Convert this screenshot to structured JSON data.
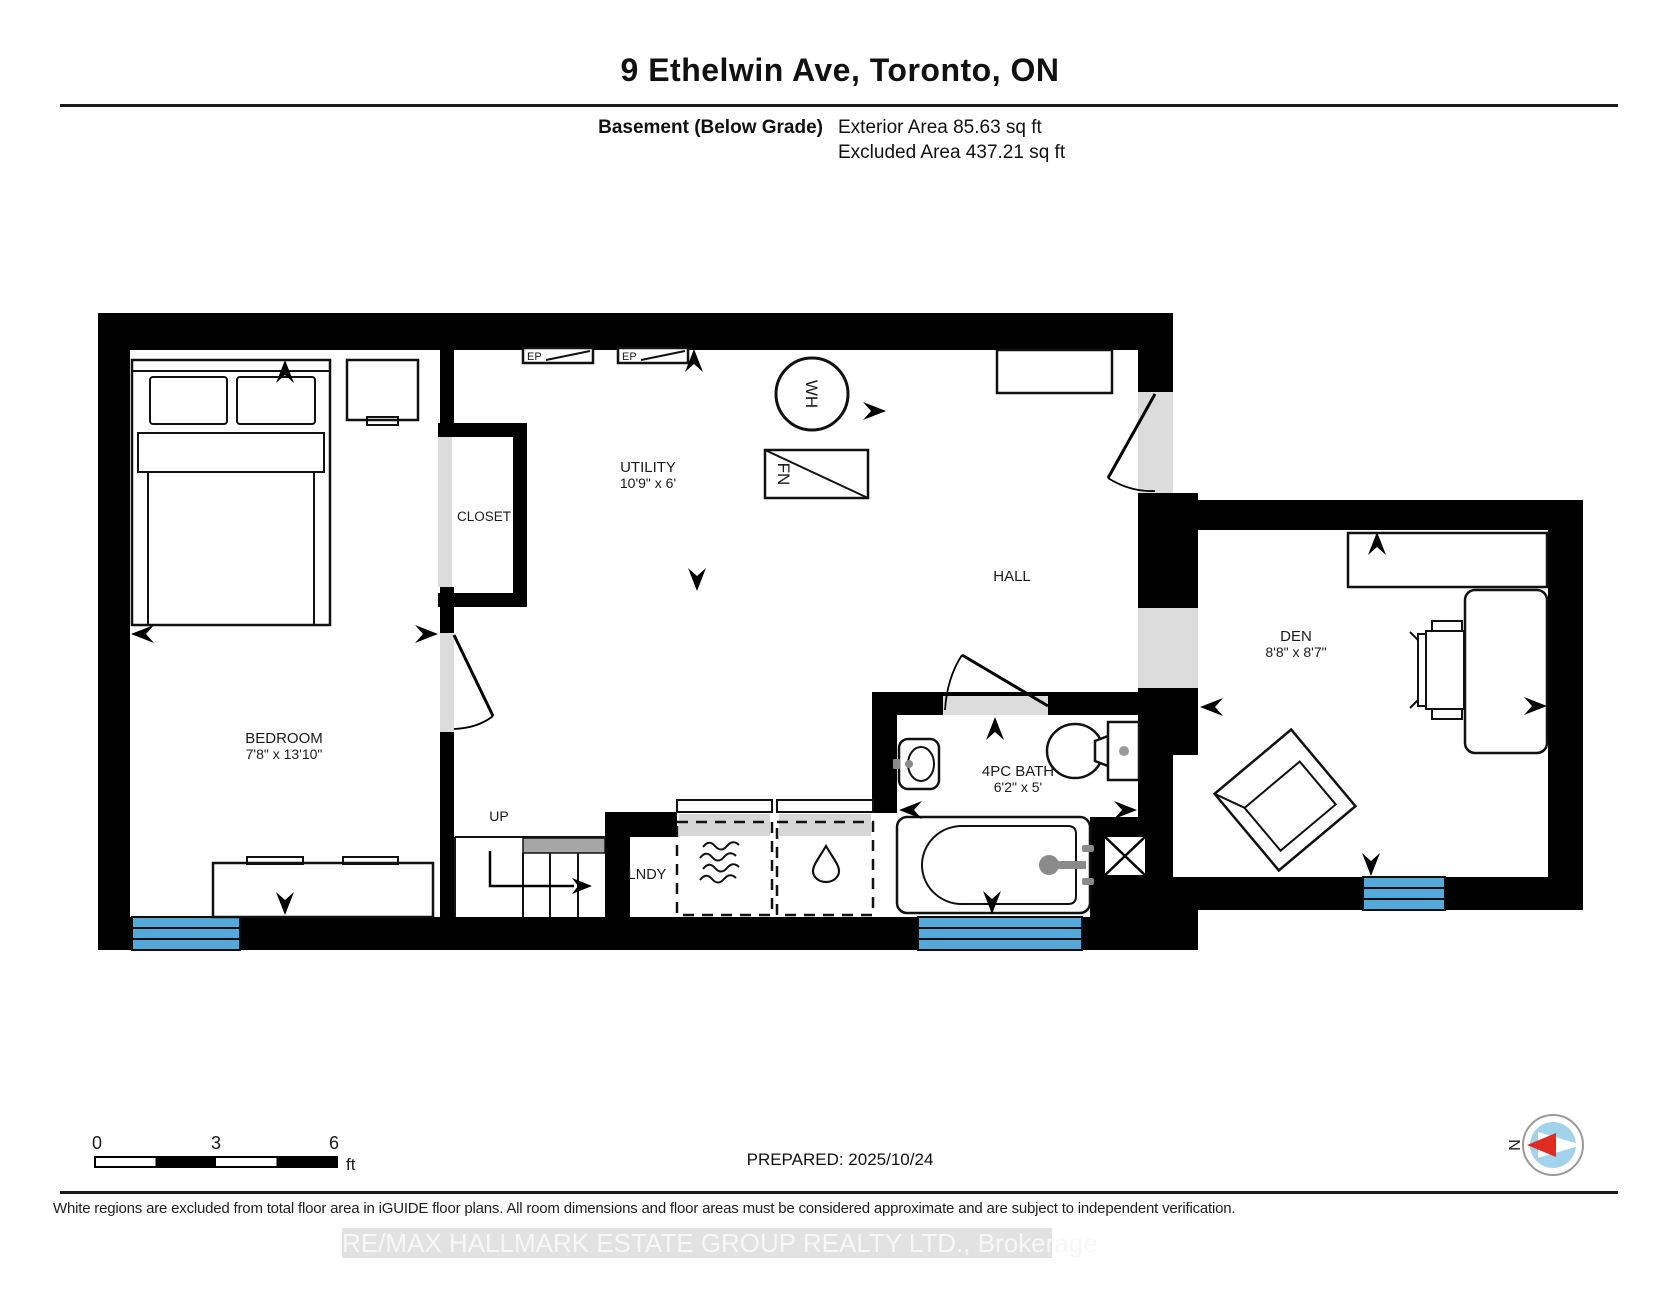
{
  "header": {
    "address": "9 Ethelwin Ave, Toronto, ON",
    "floor_label": "Basement (Below Grade)",
    "exterior_area": "Exterior Area 85.63 sq ft",
    "excluded_area": "Excluded Area 437.21 sq ft"
  },
  "rooms": {
    "bedroom": {
      "name": "BEDROOM",
      "dims": "7'8\" x 13'10\""
    },
    "closet": {
      "name": "CLOSET"
    },
    "utility": {
      "name": "UTILITY",
      "dims": "10'9\" x 6'"
    },
    "hall": {
      "name": "HALL"
    },
    "den": {
      "name": "DEN",
      "dims": "8'8\" x 8'7\""
    },
    "bath": {
      "name": "4PC BATH",
      "dims": "6'2\" x 5'"
    },
    "laundry": {
      "name": "LNDY"
    }
  },
  "equipment": {
    "water_heater": "WH",
    "furnace": "FN",
    "electrical_panel_1": "EP",
    "electrical_panel_2": "EP",
    "stairs_up": "UP"
  },
  "scale_bar": {
    "tick_0": "0",
    "tick_3": "3",
    "tick_6": "6",
    "unit": "ft"
  },
  "compass": {
    "north": "N"
  },
  "footer": {
    "prepared": "PREPARED: 2025/10/24",
    "disclaimer": "White regions are excluded from total floor area in iGUIDE floor plans. All room dimensions and floor areas must be considered approximate and are subject to independent verification.",
    "watermark": "RE/MAX HALLMARK ESTATE GROUP REALTY LTD., Brokerage"
  },
  "colors": {
    "window_well_blue": "#54a9da",
    "compass_needle_red": "#df2b20",
    "compass_disc_blue": "#a3d3ea"
  }
}
